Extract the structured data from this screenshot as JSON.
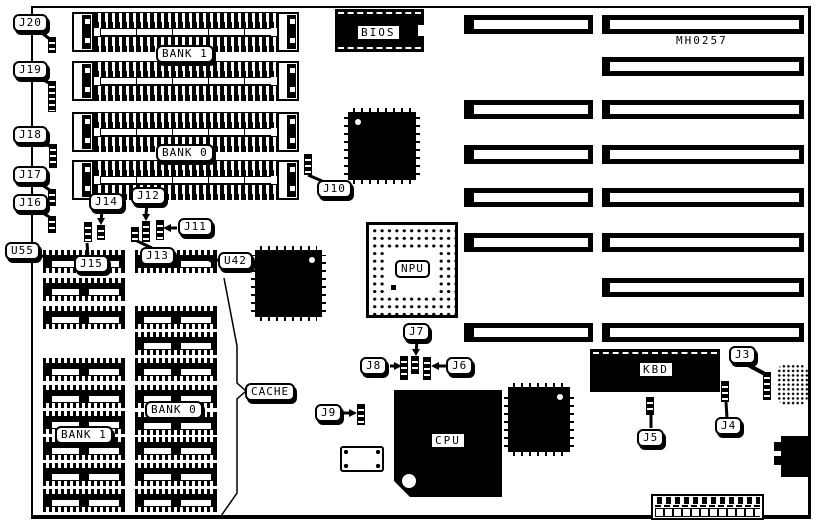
{
  "board": {
    "part_number": "MH0257"
  },
  "callouts": {
    "j3": "J3",
    "j4": "J4",
    "j5": "J5",
    "j6": "J6",
    "j7": "J7",
    "j8": "J8",
    "j9": "J9",
    "j10": "J10",
    "j11": "J11",
    "j12": "J12",
    "j13": "J13",
    "j14": "J14",
    "j15": "J15",
    "j16": "J16",
    "j17": "J17",
    "j18": "J18",
    "j19": "J19",
    "j20": "J20",
    "u42": "U42",
    "u55": "U55"
  },
  "chips": {
    "bios": "BIOS",
    "npu": "NPU",
    "cpu": "CPU",
    "kbd": "KBD"
  },
  "memory": {
    "simm_bank_top": "BANK 1",
    "simm_bank_bottom": "BANK 0",
    "cache_group": "CACHE",
    "cache_bank_left": "BANK 1",
    "cache_bank_right": "BANK 0"
  }
}
